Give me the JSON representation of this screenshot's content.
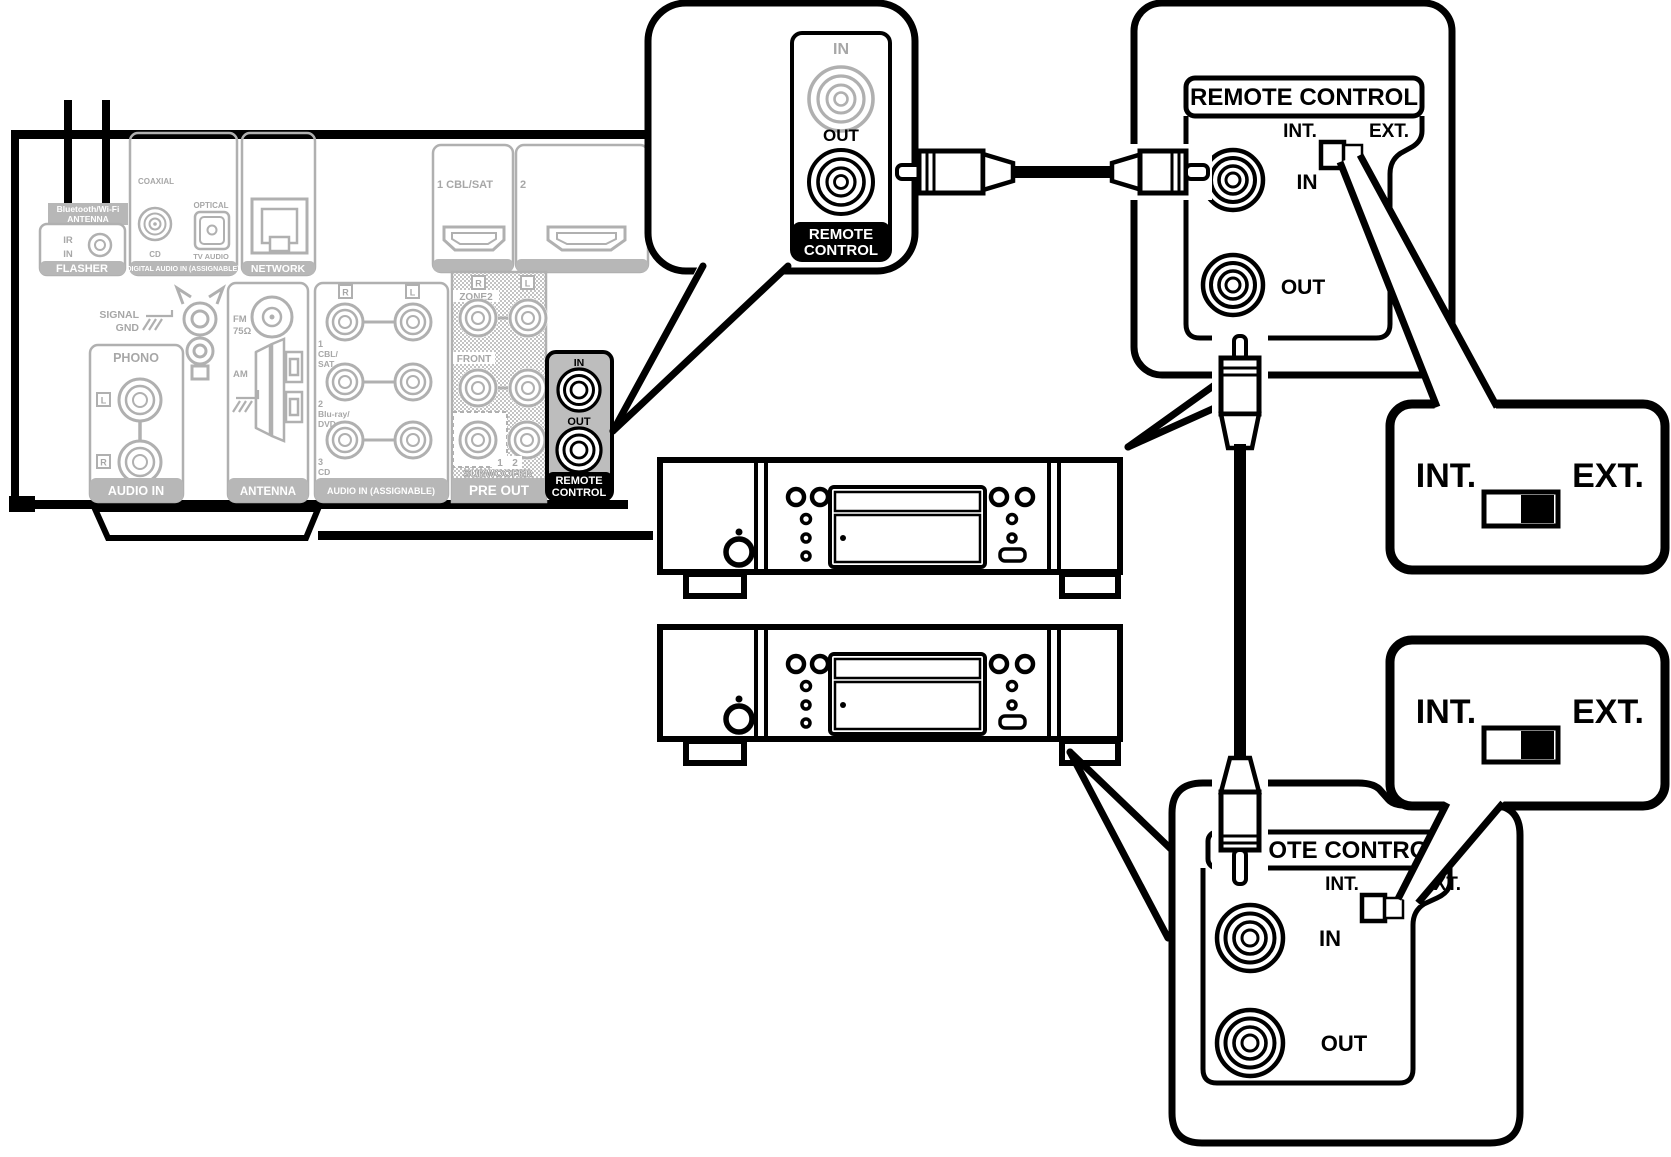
{
  "receiver": {
    "bt_antenna": {
      "line1": "Bluetooth/Wi-Fi",
      "line2": "ANTENNA"
    },
    "flasher": {
      "ir": "IR",
      "in": "IN",
      "label": "FLASHER"
    },
    "digital": {
      "coaxial": "COAXIAL",
      "cd": "CD",
      "optical": "OPTICAL",
      "tv": "TV AUDIO",
      "label": "DIGITAL AUDIO IN (ASSIGNABLE)"
    },
    "network": {
      "label": "NETWORK"
    },
    "hdmi1": {
      "label": "1 CBL/SAT"
    },
    "hdmi2": {
      "label": "2"
    },
    "signal_gnd": {
      "line1": "SIGNAL",
      "line2": "GND"
    },
    "phono": {
      "title": "PHONO",
      "l": "L",
      "r": "R",
      "label": "AUDIO IN"
    },
    "antenna": {
      "fm": "FM",
      "ohm": "75Ω",
      "am": "AM",
      "label": "ANTENNA"
    },
    "audio_in": {
      "header_r": "R",
      "header_l": "L",
      "r1a": "1",
      "r1b": "CBL/",
      "r1c": "SAT",
      "r2a": "2",
      "r2b": "Blu-ray/",
      "r2c": "DVD",
      "r3a": "3",
      "r3b": "CD",
      "label": "AUDIO IN (ASSIGNABLE)"
    },
    "pre_out": {
      "header_r": "R",
      "header_l": "L",
      "zone2": "ZONE2",
      "front": "FRONT",
      "sub1": "1",
      "sub2": "2",
      "subwoofer": "SUBWOOFER",
      "label": "PRE OUT"
    },
    "remote": {
      "in": "IN",
      "out": "OUT",
      "label1": "REMOTE",
      "label2": "CONTROL"
    }
  },
  "bubble": {
    "in": "IN",
    "out": "OUT",
    "label1": "REMOTE",
    "label2": "CONTROL"
  },
  "panel_top": {
    "title": "REMOTE CONTROL",
    "int": "INT.",
    "ext": "EXT.",
    "in": "IN",
    "out": "OUT"
  },
  "panel_bottom": {
    "title": "REMOTE CONTROL",
    "int": "INT.",
    "ext": "EXT.",
    "in": "IN",
    "out": "OUT"
  },
  "callout1": {
    "int": "INT.",
    "ext": "EXT."
  },
  "callout2": {
    "int": "INT.",
    "ext": "EXT."
  },
  "colors": {
    "line_gray": "#b0b0b0",
    "bar_gray": "#b7b7b7",
    "remote_bg": "#bdbdbd",
    "black": "#000000"
  }
}
